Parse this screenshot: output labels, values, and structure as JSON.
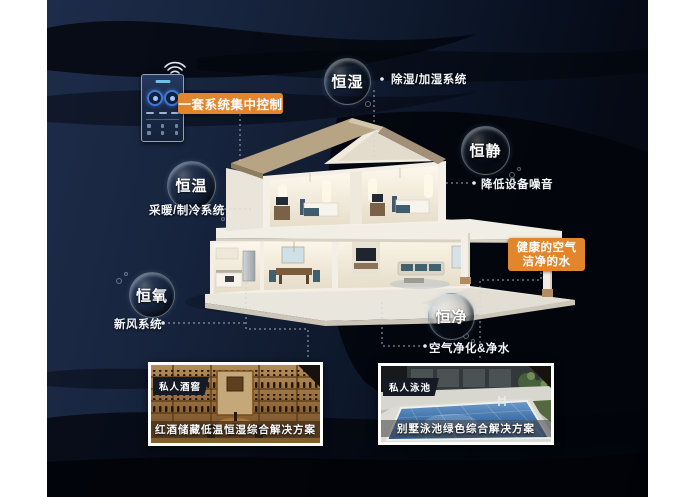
{
  "bubbles": [
    {
      "label": "恒湿"
    },
    {
      "label": "恒静"
    },
    {
      "label": "恒温"
    },
    {
      "label": "恒氧"
    },
    {
      "label": "恒净"
    }
  ],
  "banner": {
    "label": "一套系统集中控制"
  },
  "callouts": {
    "humidity": "除湿/加湿系统",
    "quiet": "降低设备噪音",
    "temperature": "采暖/制冷系统",
    "oxygen": "新风系统",
    "clean": "空气净化&净水"
  },
  "highlight": {
    "line1": "健康的空气",
    "line2": "洁净的水"
  },
  "cards": [
    {
      "tag": "私人酒窖",
      "caption": "红酒储藏低温恒湿综合解决方案"
    },
    {
      "tag": "私人泳池",
      "caption": "别墅泳池绿色综合解决方案"
    }
  ],
  "icons": {
    "wifi": "wifi-icon"
  },
  "colors": {
    "accent_orange": "#e2862e",
    "panel_navy": "#18253f",
    "wave_black": "#04070e",
    "label_text": "#f2f5f9"
  }
}
